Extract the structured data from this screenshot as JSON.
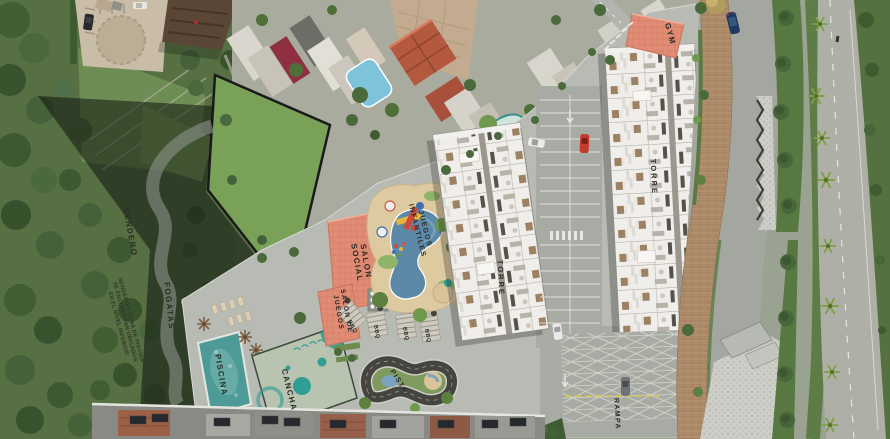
{
  "plan": {
    "labels": {
      "sendero": "SENDERO",
      "fogatas": "FOGATAS",
      "piscina": "PISCINA",
      "cancha": "CANCHA",
      "salon_social_l1": "SALON",
      "salon_social_l2": "SOCIAL",
      "salon_juegos_l1": "SALON DE",
      "salon_juegos_l2": "JUEGOS",
      "juegos_l1": "JUEGOS",
      "juegos_l2": "INFANTILES",
      "bbq": "BBQ",
      "pista": "PISTA",
      "torre": "TORRE",
      "gym": "GYM",
      "rampa": "RAMPA"
    },
    "note": {
      "l1": "SENDERO Y ZONA DE PISCINA",
      "l2": "SE ENCUENTRAN UBICADOS",
      "l3": "EN EL NIVEL INFERIOR"
    },
    "colors": {
      "amenity_salmon": "#e18c74",
      "pool_teal": "#4d9a96",
      "court_teal": "#2f9f93",
      "playground_sand": "#decaa0",
      "track_dark": "#45443f",
      "platform_gray": "#b8bbb4"
    }
  }
}
